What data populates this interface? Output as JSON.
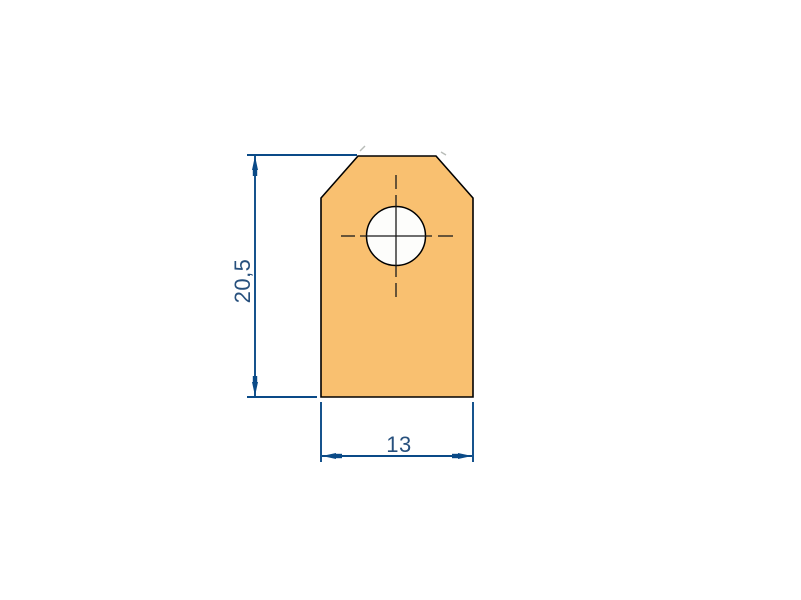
{
  "drawing": {
    "colors": {
      "background": "#FFFFFF",
      "profile-fill": "#F9C070",
      "profile-outline": "#000000",
      "hole-fill": "#FDFDFB",
      "dimension-line": "#0A4A87",
      "dimension-text": "#27507D",
      "centerline-color": "#1A1A1A",
      "artifact-gray": "#B8BCB8"
    },
    "dimensions": {
      "height": {
        "value": "20,5"
      },
      "width": {
        "value": "13"
      }
    }
  }
}
